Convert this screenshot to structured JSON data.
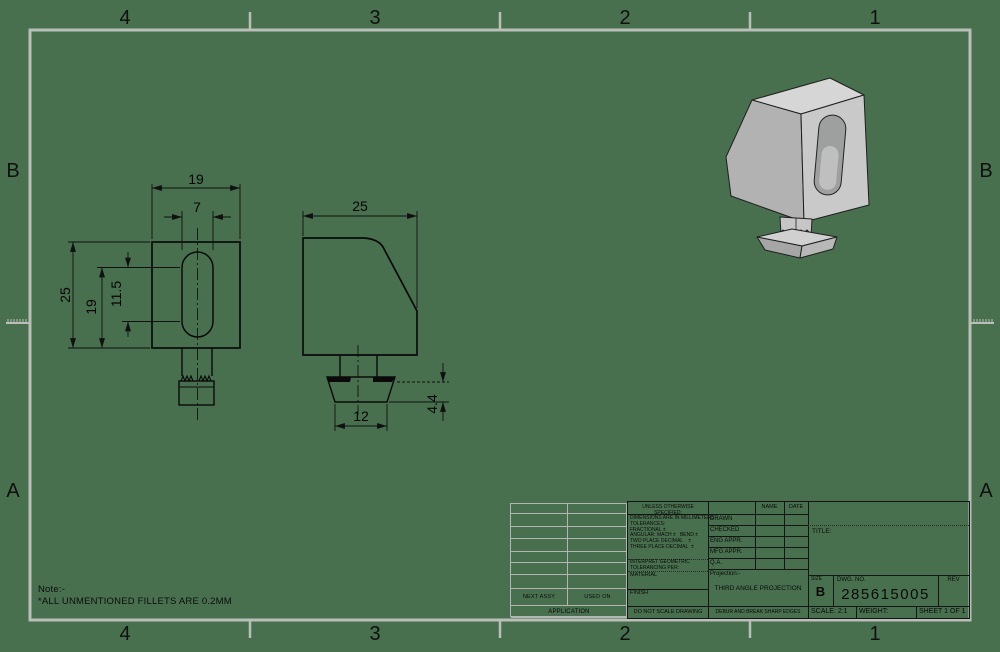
{
  "sheet": {
    "background_color": "#48704E",
    "frame_color": "#B9BEB9",
    "line_color": "#141414",
    "zones": {
      "cols": [
        "4",
        "3",
        "2",
        "1"
      ],
      "rows": [
        "B",
        "A"
      ]
    }
  },
  "note": {
    "label": "Note:-",
    "text": "*ALL UNMENTIONED FILLETS ARE 0.2MM"
  },
  "views": {
    "front": {
      "dim_width": "19",
      "dim_slot_width": "7",
      "dim_height": "25",
      "dim_slot_top": "19",
      "dim_slot_length": "11.5"
    },
    "side": {
      "dim_width": "25",
      "dim_foot_width": "12",
      "dim_foot_height": "4.4"
    }
  },
  "title_block": {
    "spec_header": "UNLESS OTHERWISE SPECIFIED:",
    "tolerance_lines": [
      "DIMENSIONS ARE IN MILLIMETERS",
      "TOLERANCES:",
      "FRACTIONAL ±",
      "ANGULAR: MACH ±   BEND ±",
      "TWO PLACE DECIMAL    ±",
      "THREE PLACE DECIMAL  ±"
    ],
    "interpret_line1": "INTERPRET GEOMETRIC",
    "interpret_line2": "TOLERANCING PER:",
    "material_label": "MATERIAL",
    "finish_label": "FINISH",
    "do_not_scale": "DO NOT SCALE DRAWING",
    "name_header": "NAME",
    "date_header": "DATE",
    "approval_rows": [
      "DRAWN",
      "CHECKED",
      "ENG APPR.",
      "MFG APPR.",
      "Q.A."
    ],
    "projection_label": "Projection:-",
    "projection_value": "THIRD ANGLE PROJECTION",
    "edges_note": "DEBUR AND BREAK SHARP EDGES",
    "title_label": "TITLE:",
    "size_label": "SIZE",
    "size_value": "B",
    "dwg_label": "DWG.  NO.",
    "dwg_number": "285615005",
    "rev_label": "REV",
    "scale_label": "SCALE: 2:1",
    "weight_label": "WEIGHT:",
    "sheet_label": "SHEET 1 OF 1",
    "next_assy": "NEXT ASSY",
    "used_on": "USED ON",
    "application": "APPLICATION"
  }
}
